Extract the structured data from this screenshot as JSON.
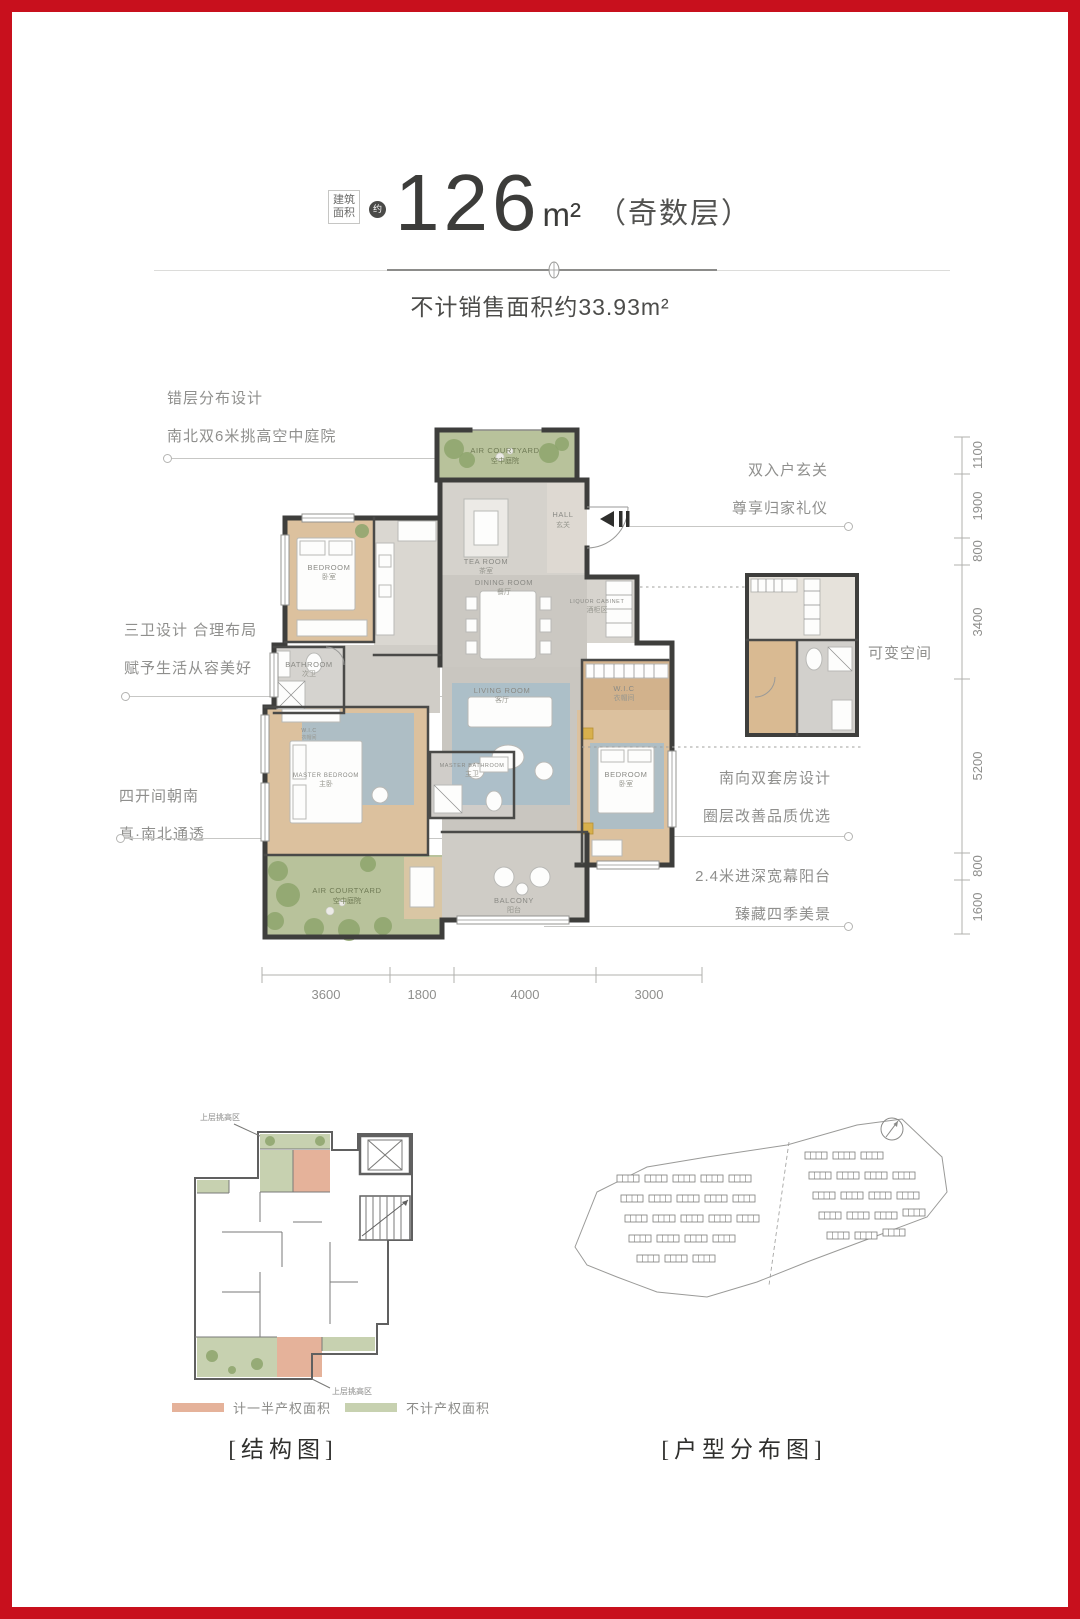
{
  "page": {
    "border_color": "#c8101d"
  },
  "header": {
    "area_label_line1": "建筑",
    "area_label_line2": "面积",
    "approx_badge": "约",
    "area_value": "126",
    "area_unit": "m²",
    "floor_note": "（奇数层）",
    "subtitle": "不计销售面积约33.93m²"
  },
  "annotations": {
    "stagger": {
      "line1": "错层分布设计",
      "line2": "南北双6米挑高空中庭院"
    },
    "bathrooms": {
      "line1": "三卫设计 合理布局",
      "line2": "赋予生活从容美好"
    },
    "south": {
      "line1": "四开间朝南",
      "line2": "真·南北通透"
    },
    "entry": {
      "line1": "双入户玄关",
      "line2": "尊享归家礼仪"
    },
    "flex_space": {
      "label": "可变空间"
    },
    "suite": {
      "line1": "南向双套房设计",
      "line2": "圈层改善品质优选"
    },
    "balcony": {
      "line1": "2.4米进深宽幕阳台",
      "line2": "臻藏四季美景"
    }
  },
  "floorplan": {
    "rooms": [
      {
        "name_en": "AIR COURTYARD",
        "name_zh": "空中庭院"
      },
      {
        "name_en": "HALL",
        "name_zh": "玄关"
      },
      {
        "name_en": "TEA ROOM",
        "name_zh": "茶室"
      },
      {
        "name_en": "DINING ROOM",
        "name_zh": "餐厅"
      },
      {
        "name_en": "BEDROOM",
        "name_zh": "卧室"
      },
      {
        "name_en": "BATHROOM",
        "name_zh": "次卫"
      },
      {
        "name_en": "LIQUOR CABINET",
        "name_zh": "酒柜区"
      },
      {
        "name_en": "LIVING ROOM",
        "name_zh": "客厅"
      },
      {
        "name_en": "W.I.C",
        "name_zh": "衣帽间"
      },
      {
        "name_en": "BEDROOM",
        "name_zh": "卧室"
      },
      {
        "name_en": "MASTER BATHROOM",
        "name_zh": "主卫"
      },
      {
        "name_en": "MASTER BEDROOM",
        "name_zh": "主卧"
      },
      {
        "name_en": "AIR COURTYARD",
        "name_zh": "空中庭院"
      },
      {
        "name_en": "BALCONY",
        "name_zh": "阳台"
      },
      {
        "name_en": "W.I.C",
        "name_zh": "衣帽间"
      }
    ],
    "colors": {
      "wall": "#3e3e3c",
      "wood_floor": "#dcc19e",
      "stone_floor": "#cbc8c2",
      "courtyard_green": "#b8c29b",
      "rug_blue": "#a9bec9"
    }
  },
  "dimensions": {
    "right": [
      "1100",
      "1900",
      "800",
      "3400",
      "5200",
      "800",
      "1600"
    ],
    "bottom": [
      "3600",
      "1800",
      "4000",
      "3000"
    ]
  },
  "legend": {
    "items": [
      {
        "label": "计一半产权面积",
        "color": "#e5b29a"
      },
      {
        "label": "不计产权面积",
        "color": "#c7d1b0"
      }
    ]
  },
  "structure_diagram": {
    "note_top": "上层挑高区",
    "note_bottom": "上层挑高区"
  },
  "captions": {
    "structure": "[结构图]",
    "distribution": "[户型分布图]"
  }
}
